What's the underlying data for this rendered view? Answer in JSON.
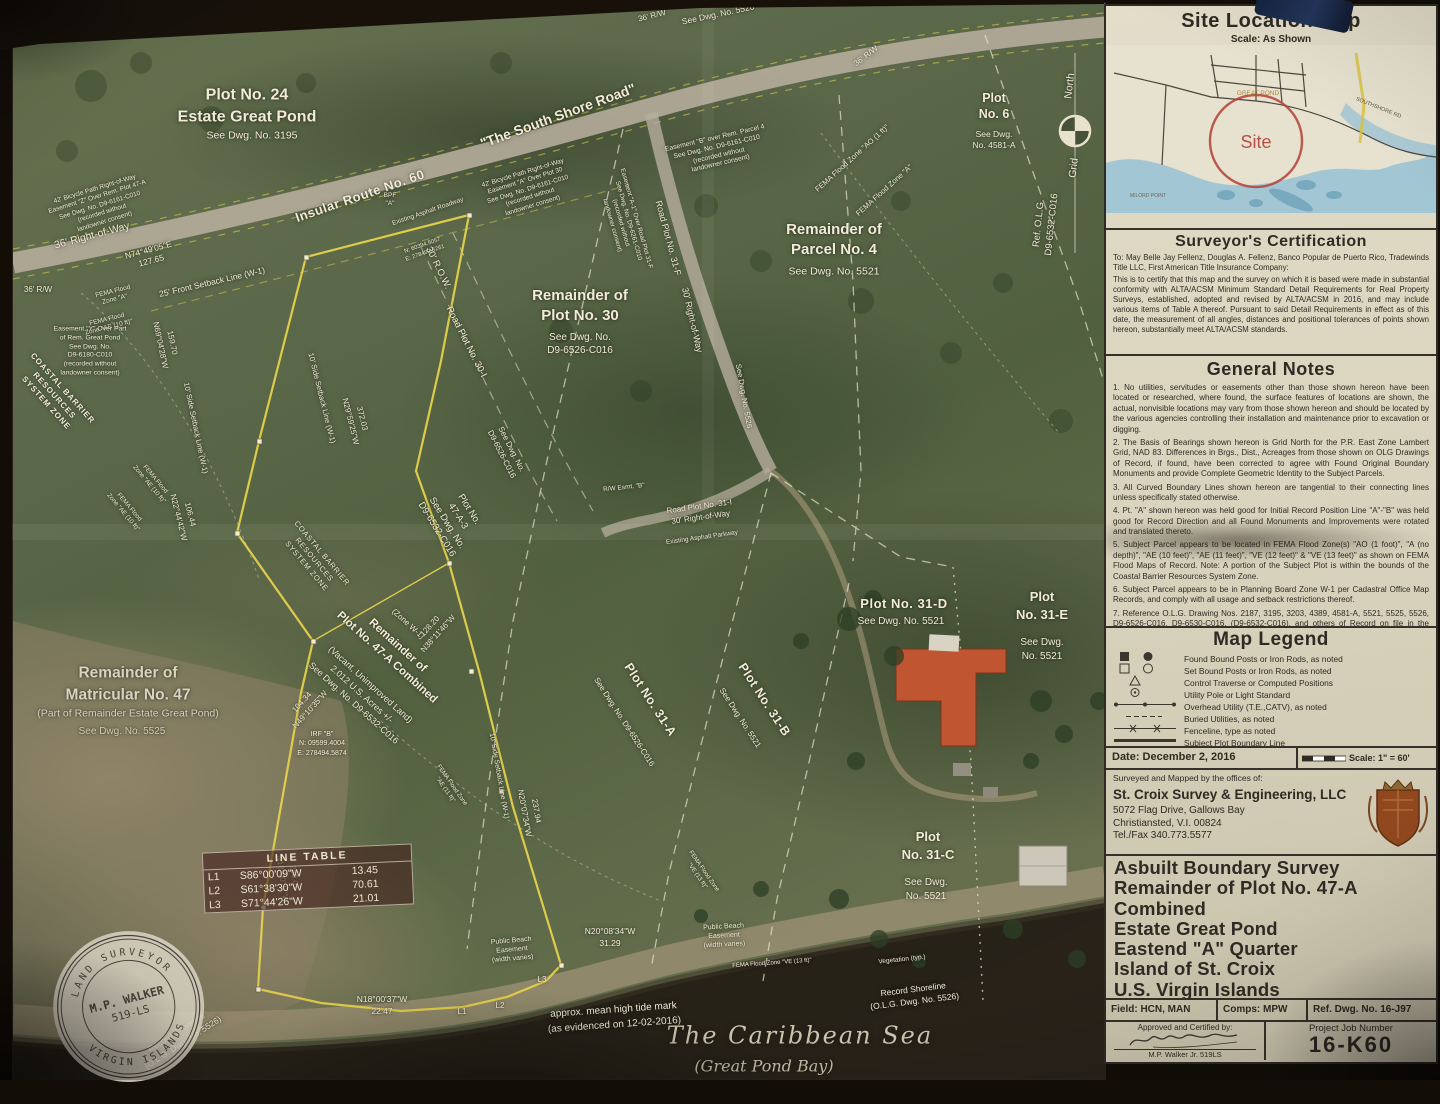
{
  "panel": {
    "site_location_map": {
      "title": "Site Location Map",
      "scale": "Scale: As Shown",
      "site_label": "Site",
      "inset_labels": [
        "GREAT POND",
        "SOUTHSHORE RD",
        "MILORD POINT"
      ]
    },
    "surveyors_certification": {
      "title": "Surveyor's Certification",
      "to_line": "To: May Belle Jay Fellenz, Douglas A. Fellenz, Banco Popular de Puerto Rico, Tradewinds Title LLC, First American Title Insurance Company:",
      "body": "This is to certify that this map and the survey on which it is based were made in substantial conformity with ALTA/ACSM Minimum Standard Detail Requirements for Real Property Surveys, established, adopted and revised by ALTA/ACSM in 2016, and may include various items of Table A thereof.  Pursuant to said Detail Requirements in effect as of this date, the measurement of all angles, distances and positional tolerances of points shown hereon, substantially meet ALTA/ACSM standards."
    },
    "general_notes": {
      "title": "General Notes",
      "notes": [
        "1.  No utilities, servitudes or easements other than those shown hereon have been located or researched, where found, the surface features of locations are shown, the actual, nonvisible locations may vary from those shown hereon and should be located by the various agencies controlling their installation and maintenance prior to excavation or digging.",
        "2. The Basis of Bearings shown hereon is Grid North for the P.R. East Zone Lambert Grid, NAD 83.  Differences in Brgs., Dist., Acreages from those shown on OLG Drawings of Record, if found, have been corrected to agree with Found Original Boundary Monuments and provide Complete Geometric Identity to the Subject Parcels.",
        "3. All Curved Boundary Lines shown hereon are tangential to their connecting lines unless specifically stated otherwise.",
        "4. Pt. \"A\" shown hereon was held good for Initial Record Position Line \"A\"-\"B\" was held good for Record Direction and all Found Monuments and Improvements were rotated and translated thereto.",
        "5. Subject Parcel appears to be located in FEMA Flood Zone(s) \"AO (1 foot)\", \"A (no depth)\", \"AE (10 feet)\", \"AE (11 feet)\", \"VE (12 feet)\" & \"VE (13 feet)\" as shown on FEMA Flood Maps of Record.  Note: A portion of the Subject Plot is within the bounds of the Coastal Barrier Resources System Zone.",
        "6. Subject Parcel appears to be in Planning Board Zone W-1 per Cadastral Office Map Records, and comply with all usage and setback restrictions thereof.",
        "7. Reference O.L.G. Drawing Nos. 2187, 3195, 3203, 4389, 4581-A, 5521, 5525, 5526, D9-6526-C016, D9-6530-C016, (D9-6532-C016), and others of Record on file in the Cadastral Office of the Lt. Governor's Office, Christiansted, USVI."
      ]
    },
    "map_legend": {
      "title": "Map Legend",
      "items": [
        {
          "symbol": "found-posts",
          "label": "Found Bound Posts or Iron Rods, as noted"
        },
        {
          "symbol": "set-posts",
          "label": "Set Bound Posts or Iron Rods, as noted"
        },
        {
          "symbol": "control-traverse",
          "label": "Control Traverse or Computed Positions"
        },
        {
          "symbol": "utility-pole",
          "label": "Utility Pole or Light Standard"
        },
        {
          "symbol": "overhead-utility",
          "label": "Overhead Utility (T.E.,CATV), as noted"
        },
        {
          "symbol": "buried-utilities",
          "label": "Buried Utilities, as noted"
        },
        {
          "symbol": "fenceline",
          "label": "Fenceline, type as noted"
        },
        {
          "symbol": "subject-boundary",
          "label": "Subject Plot Boundary Line"
        }
      ]
    },
    "date_row": {
      "date": "Date: December 2, 2016",
      "scale": "Scale: 1\" = 60'"
    },
    "surveyor_block": {
      "prefix": "Surveyed and Mapped by the offices of:",
      "name": "St. Croix Survey & Engineering, LLC",
      "address1": "5072 Flag Drive, Gallows Bay",
      "address2": "Christiansted, V.I. 00824",
      "phone": "Tel./Fax 340.773.5577"
    },
    "title_block": {
      "lines": [
        "Asbuilt Boundary Survey",
        "Remainder of Plot No. 47-A",
        "Combined",
        "Estate Great Pond",
        "Eastend \"A\" Quarter",
        "Island of St. Croix",
        "U.S. Virgin Islands"
      ]
    },
    "fields_row": {
      "field": "Field: HCN, MAN",
      "comps": "Comps: MPW",
      "ref": "Ref. Dwg. No. 16-J97"
    },
    "approval": {
      "label": "Approved and Certified by:",
      "name": "M.P. Walker Jr. 519LS"
    },
    "job": {
      "label": "Project Job Number",
      "number": "16-K60"
    }
  },
  "map": {
    "line_table": {
      "title": "LINE TABLE",
      "rows": [
        [
          "L1",
          "S86°00'09\"W",
          "13.45"
        ],
        [
          "L2",
          "S61°38'30\"W",
          "70.61"
        ],
        [
          "L3",
          "S71°44'26\"W",
          "21.01"
        ]
      ]
    },
    "seal": {
      "top": "LAND SURVEYOR",
      "center1": "M.P. WALKER",
      "center2": "519-LS",
      "bottom": "VIRGIN ISLANDS"
    },
    "labels": [
      {
        "t": "Plot No. 24|Estate Great Pond",
        "x": 247,
        "y": 106,
        "s": 16,
        "w": 700,
        "lh": 1.35
      },
      {
        "t": "See Dwg. No. 3195",
        "x": 252,
        "y": 136,
        "s": 10.5
      },
      {
        "t": "\"The South Shore Road\"",
        "x": 558,
        "y": 116,
        "r": -20,
        "s": 14,
        "w": 700
      },
      {
        "t": "Insular Route No. 60",
        "x": 360,
        "y": 196,
        "r": -19,
        "s": 13,
        "w": 700,
        "ls": 0.5
      },
      {
        "t": "Existing Asphalt Roadway",
        "x": 428,
        "y": 212,
        "r": -19,
        "s": 6.5
      },
      {
        "t": "36' Right-of-Way",
        "x": 92,
        "y": 236,
        "r": -15,
        "s": 10.5
      },
      {
        "t": "36' R/W",
        "x": 652,
        "y": 16,
        "r": -14,
        "s": 8
      },
      {
        "t": "See Dwg. No. 5526",
        "x": 718,
        "y": 14,
        "r": -12,
        "s": 8.5
      },
      {
        "t": "36' R/W",
        "x": 866,
        "y": 56,
        "r": -38,
        "s": 8
      },
      {
        "t": "42' Bicycle Path Right-of-Way|Easement \"Z\" Over Rem. Plot 47-A|See Dwg. No. D9-6161-C010|(recorded without|landowner consent)",
        "x": 100,
        "y": 206,
        "r": -17,
        "s": 6.5,
        "lh": 1.3
      },
      {
        "t": "42' Bicycle Path Right-of-Way|Easement \"A\" Over Plot 30|See Dwg. No. D9-6161-C010|(recorded without|landowner consent)",
        "x": 528,
        "y": 190,
        "r": -17,
        "s": 6.5,
        "lh": 1.3
      },
      {
        "t": "Easement \"B\" over Rem. Parcel 4|See Dwg. No. D9-6161-C010|(recorded without|landowner consent)",
        "x": 718,
        "y": 152,
        "r": -13,
        "s": 6.8,
        "lh": 1.3
      },
      {
        "t": "Easement \"A-1\" Over Road Plot 31-F|See Dwg. No. D9-6261-C010|(recorded without|landowner consent)",
        "x": 624,
        "y": 222,
        "r": 74,
        "s": 6.3,
        "lh": 1.3
      },
      {
        "t": "BPF|\"A\"",
        "x": 390,
        "y": 200,
        "s": 6.5,
        "lh": 1.25
      },
      {
        "t": "Road Plot No. 31-F",
        "x": 668,
        "y": 238,
        "r": 75,
        "s": 9
      },
      {
        "t": "30' Right-of-Way",
        "x": 692,
        "y": 320,
        "r": 77,
        "s": 9
      },
      {
        "t": "See Dwg. No. 5526",
        "x": 744,
        "y": 396,
        "r": 80,
        "s": 7.5
      },
      {
        "t": "Plot|No. 6",
        "x": 994,
        "y": 106,
        "s": 12.5,
        "w": 700,
        "lh": 1.3
      },
      {
        "t": "See Dwg.|No. 4581-A",
        "x": 994,
        "y": 140,
        "s": 8.5,
        "lh": 1.3
      },
      {
        "t": "North",
        "x": 1070,
        "y": 86,
        "r": -83,
        "s": 10.5
      },
      {
        "t": "Grid",
        "x": 1074,
        "y": 168,
        "r": -83,
        "s": 10.5
      },
      {
        "t": "Ref. O.L.G.|D9-6532-C016",
        "x": 1046,
        "y": 224,
        "r": -84,
        "s": 9.5,
        "lh": 1.35
      },
      {
        "t": "FEMA Flood Zone \"AO (1 ft)\"",
        "x": 852,
        "y": 158,
        "r": -42,
        "s": 7.5
      },
      {
        "t": "FEMA Flood Zone \"A\"",
        "x": 884,
        "y": 190,
        "r": -42,
        "s": 7.5
      },
      {
        "t": "Remainder of|Parcel No. 4",
        "x": 834,
        "y": 240,
        "s": 15,
        "w": 700,
        "lh": 1.35
      },
      {
        "t": "See Dwg. No. 5521",
        "x": 834,
        "y": 272,
        "s": 10.5
      },
      {
        "t": "N74°49'05\"E|127.65",
        "x": 150,
        "y": 256,
        "r": -15,
        "s": 8.5,
        "lh": 1.35
      },
      {
        "t": "N: 60394.5057|E: 278492.8261",
        "x": 424,
        "y": 250,
        "r": -19,
        "s": 5.8,
        "lh": 1.3
      },
      {
        "t": "30' R.O.W.",
        "x": 438,
        "y": 268,
        "r": 64,
        "s": 9.5
      },
      {
        "t": "Road Plot No. 30-I",
        "x": 466,
        "y": 342,
        "r": 63,
        "s": 9.5
      },
      {
        "t": "See Dwg. No.|D9-6526-C016",
        "x": 506,
        "y": 452,
        "r": 63,
        "s": 8,
        "lh": 1.35
      },
      {
        "t": "Remainder of|Plot No. 30",
        "x": 580,
        "y": 306,
        "s": 15,
        "w": 700,
        "lh": 1.35
      },
      {
        "t": "See Dwg. No.|D9-6526-C016",
        "x": 580,
        "y": 344,
        "s": 10,
        "lh": 1.3
      },
      {
        "t": "36' R/W",
        "x": 38,
        "y": 290,
        "s": 8
      },
      {
        "t": "FEMA Flood|Zone \"A\"",
        "x": 114,
        "y": 296,
        "r": -14,
        "s": 6.5,
        "lh": 1.25
      },
      {
        "t": "FEMA Flood|Zone \"AE (10 ft)\"",
        "x": 108,
        "y": 324,
        "r": -14,
        "s": 6.5,
        "lh": 1.25
      },
      {
        "t": "Easement \"Y\" Over Part|of Rem. Great Pond|See Dwg. No.|D9-6180-C010|(recorded without|landowner consent)",
        "x": 90,
        "y": 352,
        "s": 6.8,
        "lh": 1.3
      },
      {
        "t": "25' Front Setback Line (W-1)",
        "x": 212,
        "y": 282,
        "r": -13,
        "s": 8.5
      },
      {
        "t": "159.70|N69°04'28\"W",
        "x": 166,
        "y": 344,
        "r": 78,
        "s": 8,
        "lh": 1.5
      },
      {
        "t": "10' Side Setback Line (W-1)",
        "x": 196,
        "y": 428,
        "r": 78,
        "s": 7.5
      },
      {
        "t": "106.44|N22°44'42\"W",
        "x": 184,
        "y": 516,
        "r": 76,
        "s": 8,
        "lh": 1.5
      },
      {
        "t": "COASTAL BARRIER|RESOURCES|SYSTEM ZONE",
        "x": 54,
        "y": 396,
        "r": 48,
        "s": 8,
        "w": 600,
        "lh": 1.35,
        "ls": 1
      },
      {
        "t": "FEMA Flood|Zone \"AE (10 ft)\"",
        "x": 152,
        "y": 482,
        "r": 50,
        "s": 6.3,
        "lh": 1.25
      },
      {
        "t": "FEMA Flood|Zone \"AE (10 ft)\"",
        "x": 126,
        "y": 510,
        "r": 50,
        "s": 6.3,
        "lh": 1.25
      },
      {
        "t": "372.03|N29°59'25\"W",
        "x": 356,
        "y": 420,
        "r": 76,
        "s": 8,
        "lh": 1.5
      },
      {
        "t": "10' Side Setback Line (W-1)",
        "x": 322,
        "y": 398,
        "r": 76,
        "s": 7.5
      },
      {
        "t": "Plot No.|47-A-3|See Dwg. No.|D9-6532-C016",
        "x": 452,
        "y": 520,
        "r": 58,
        "s": 9.5,
        "lh": 1.35
      },
      {
        "t": "(Zone W-1)",
        "x": 408,
        "y": 624,
        "r": 42,
        "s": 8
      },
      {
        "t": "Remainder of|Plot No. 47-A Combined",
        "x": 392,
        "y": 652,
        "r": 42,
        "s": 11.5,
        "w": 700,
        "lh": 1.35
      },
      {
        "t": "(Vacant, Unimproved Land)|2.012 U.S. Acres +/-|See Dwg. No. D9-6532-C016",
        "x": 362,
        "y": 694,
        "r": 42,
        "s": 9,
        "lh": 1.4
      },
      {
        "t": "104.34|N49°10'35\"W",
        "x": 306,
        "y": 706,
        "r": -48,
        "s": 8,
        "lh": 1.4
      },
      {
        "t": "128.20|N38°11'46\"W",
        "x": 434,
        "y": 630,
        "r": -48,
        "s": 8,
        "lh": 1.4
      },
      {
        "t": "IRF \"B\"|N: 09599.4004|E: 278494.5874",
        "x": 322,
        "y": 744,
        "s": 7,
        "lh": 1.35
      },
      {
        "t": "Remainder of|Matricular No. 47",
        "x": 128,
        "y": 684,
        "s": 15.5,
        "w": 600,
        "lh": 1.4,
        "c": "#d9d4c2"
      },
      {
        "t": "(Part of Remainder Estate Great Pond)",
        "x": 128,
        "y": 714,
        "s": 10.5,
        "c": "#d9d4c2"
      },
      {
        "t": "See Dwg. No. 5525",
        "x": 122,
        "y": 732,
        "s": 10,
        "c": "#d2cdbb"
      },
      {
        "t": "Plot No. 31-A",
        "x": 650,
        "y": 700,
        "r": 57,
        "s": 12.5,
        "w": 600,
        "ls": 0.5
      },
      {
        "t": "See Dwg. No. D9-6526-C016",
        "x": 624,
        "y": 722,
        "r": 57,
        "s": 8
      },
      {
        "t": "Plot No. 31-B",
        "x": 764,
        "y": 700,
        "r": 57,
        "s": 12.5,
        "w": 600,
        "ls": 0.5
      },
      {
        "t": "See Dwg. No. 5521",
        "x": 740,
        "y": 718,
        "r": 57,
        "s": 8
      },
      {
        "t": "Plot No. 31-D",
        "x": 904,
        "y": 604,
        "s": 13,
        "w": 600,
        "ls": 0.5
      },
      {
        "t": "See Dwg. No. 5521",
        "x": 901,
        "y": 622,
        "s": 10
      },
      {
        "t": "Plot|No. 31-E",
        "x": 1042,
        "y": 606,
        "s": 13,
        "w": 600,
        "lh": 1.4
      },
      {
        "t": "See Dwg.|No. 5521",
        "x": 1042,
        "y": 650,
        "s": 10,
        "lh": 1.4
      },
      {
        "t": "Plot|No. 31-C",
        "x": 928,
        "y": 846,
        "s": 13,
        "w": 600,
        "lh": 1.4
      },
      {
        "t": "See Dwg.|No. 5521",
        "x": 926,
        "y": 890,
        "s": 10,
        "lh": 1.4
      },
      {
        "t": "R/W Esmt. \"B\"",
        "x": 624,
        "y": 488,
        "r": -6,
        "s": 6.5
      },
      {
        "t": "Road Plot No. 31-I|30' Right-of-Way",
        "x": 700,
        "y": 512,
        "r": -8,
        "s": 8,
        "lh": 1.4
      },
      {
        "t": "Existing Asphalt Parkway",
        "x": 702,
        "y": 538,
        "r": -8,
        "s": 6.5
      },
      {
        "t": "237.94|N20°07'34\"W",
        "x": 530,
        "y": 812,
        "r": 80,
        "s": 8,
        "lh": 1.5
      },
      {
        "t": "10' Side Setback Line (W-1)",
        "x": 498,
        "y": 776,
        "r": 80,
        "s": 7
      },
      {
        "t": "N20°08'34\"W|31.29",
        "x": 610,
        "y": 938,
        "s": 8.5,
        "lh": 1.4
      },
      {
        "t": "Public Beach|Easement|(width varies)",
        "x": 512,
        "y": 950,
        "r": -5,
        "s": 7,
        "lh": 1.3
      },
      {
        "t": "Public Beach|Easement|(width varies)",
        "x": 724,
        "y": 936,
        "r": -3,
        "s": 7,
        "lh": 1.3
      },
      {
        "t": "approx. mean high tide mark|(as evidenced on 12-02-2016)",
        "x": 614,
        "y": 1018,
        "r": -4,
        "s": 10,
        "lh": 1.45
      },
      {
        "t": "The Caribbean Sea",
        "x": 800,
        "y": 1036,
        "s": 24,
        "f": "script",
        "c": "#ccc5ae",
        "ls": 2
      },
      {
        "t": "(Great Pond Bay)",
        "x": 764,
        "y": 1066,
        "s": 16,
        "f": "script",
        "c": "#c3bca6"
      },
      {
        "t": "Record Shoreline|(O.L.G. Dwg. No. 5526)",
        "x": 180,
        "y": 1038,
        "r": -33,
        "s": 8.5,
        "lh": 1.4
      },
      {
        "t": "Record Shoreline|(O.L.G. Dwg. No. 5526)",
        "x": 914,
        "y": 996,
        "r": -7,
        "s": 8.5,
        "lh": 1.4
      },
      {
        "t": "N18°00'37\"W|22.47",
        "x": 382,
        "y": 1006,
        "s": 8.5,
        "lh": 1.4
      },
      {
        "t": "250.01|N18°00'37\"W",
        "x": 288,
        "y": 878,
        "r": 82,
        "s": 8,
        "lh": 1.5
      },
      {
        "t": "FEMA Flood Zone|\"VE (13 ft)\"",
        "x": 700,
        "y": 874,
        "r": 55,
        "s": 6,
        "lh": 1.25
      },
      {
        "t": "FEMA Flood Zone \"VE (13 ft)\"",
        "x": 772,
        "y": 964,
        "r": -4,
        "s": 6
      },
      {
        "t": "Vegetation (typ.)",
        "x": 902,
        "y": 960,
        "r": -6,
        "s": 6.5
      },
      {
        "t": "FEMA Flood Zone|\"AE (11 ft)\"",
        "x": 448,
        "y": 788,
        "r": 55,
        "s": 6,
        "lh": 1.25
      },
      {
        "t": "COASTAL BARRIER|RESOURCES|SYSTEM ZONE",
        "x": 314,
        "y": 560,
        "r": 50,
        "s": 7.5,
        "lh": 1.35,
        "ls": 0.8
      },
      {
        "t": "L1",
        "x": 462,
        "y": 1012,
        "s": 8
      },
      {
        "t": "L2",
        "x": 500,
        "y": 1006,
        "s": 8
      },
      {
        "t": "L3",
        "x": 542,
        "y": 980,
        "s": 8
      }
    ]
  },
  "colors": {
    "boundary_yellow": "#e5d14c",
    "road_gray": "#b7ae9d",
    "paper": "#ddd6c2",
    "site_circle_red": "#b33f36",
    "roof_orange": "#bf5531",
    "sea_dark": "#221c14"
  }
}
